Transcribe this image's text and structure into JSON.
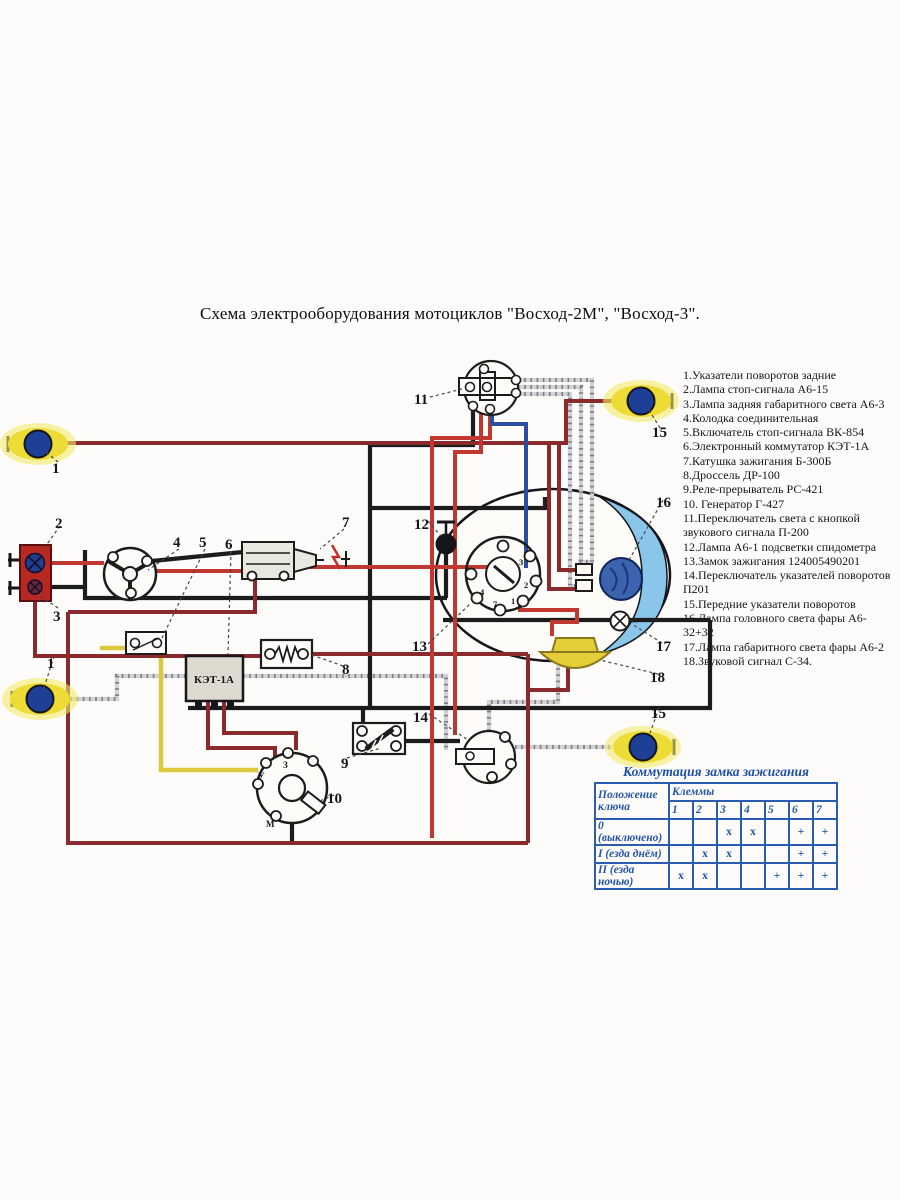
{
  "title": "Схема электрооборудования мотоциклов \"Восход-2М\", \"Восход-3\".",
  "legend": {
    "items": [
      "1.Указатели поворотов задние",
      "2.Лампа стоп-сигнала А6-15",
      "3.Лампа задняя габаритного света А6-3",
      "4.Колодка соединительная",
      "5.Включатель стоп-сигнала ВК-854",
      "6.Электронный коммутатор КЭТ-1А",
      "7.Катушка зажигания Б-300Б",
      "8.Дроссель ДР-100",
      "9.Реле-прерыватель РС-421",
      "10. Генератор Г-427",
      "11.Переключатель света с кнопкой звукового сигнала П-200",
      "12.Лампа А6-1 подсветки спидометра",
      "13.Замок зажигания 124005490201",
      "14.Переключатель указателей поворотов П201",
      "15.Передние указатели поворотов",
      "16.Лампа головного света фары А6-32+32",
      "17.Лампа габаритного света фары А6-2",
      "18.Звуковой сигнал С-34."
    ]
  },
  "table": {
    "title": "Коммутация замка зажигания",
    "key_position_header": "Положение ключа",
    "terminals_header": "Клеммы",
    "terminals": [
      "1",
      "2",
      "3",
      "4",
      "5",
      "6",
      "7"
    ],
    "rows": [
      {
        "label": "0 (выключено)",
        "cells": [
          "",
          "",
          "x",
          "x",
          "",
          "+",
          "+"
        ]
      },
      {
        "label": "I (езда днём)",
        "cells": [
          "",
          "x",
          "x",
          "",
          "",
          "+",
          "+"
        ]
      },
      {
        "label": "II (езда ночью)",
        "cells": [
          "x",
          "x",
          "",
          "",
          "+",
          "+",
          "+"
        ]
      }
    ]
  },
  "diagram": {
    "colors": {
      "wire_red": "#c03830",
      "wire_dark_red": "#8a2a2c",
      "wire_black": "#1c1c1e",
      "wire_blue": "#2b4f9e",
      "wire_yellow": "#ddc83b",
      "wire_gray": "#d2d2d6",
      "signal_lens": "#ecdc35",
      "signal_bulb": "#1d3f96",
      "tail_light_body": "#b72822",
      "headlight_lens": "#8ac6ea",
      "headlamp_bulb": "#3b63ae",
      "horn_body": "#e5cd39",
      "table_blue": "#2b5cb0"
    },
    "texts": [
      {
        "t": "1",
        "x": 52,
        "y": 473,
        "s": 15,
        "b": 1
      },
      {
        "t": "1",
        "x": 47,
        "y": 668,
        "s": 15,
        "b": 1
      },
      {
        "t": "2",
        "x": 55,
        "y": 528,
        "s": 15,
        "b": 1
      },
      {
        "t": "3",
        "x": 53,
        "y": 621,
        "s": 15,
        "b": 1
      },
      {
        "t": "4",
        "x": 173,
        "y": 547,
        "s": 15,
        "b": 1
      },
      {
        "t": "5",
        "x": 199,
        "y": 547,
        "s": 15,
        "b": 1
      },
      {
        "t": "6",
        "x": 225,
        "y": 549,
        "s": 15,
        "b": 1
      },
      {
        "t": "7",
        "x": 342,
        "y": 527,
        "s": 15,
        "b": 1
      },
      {
        "t": "8",
        "x": 342,
        "y": 674,
        "s": 15,
        "b": 1
      },
      {
        "t": "9",
        "x": 341,
        "y": 768,
        "s": 15,
        "b": 1
      },
      {
        "t": "10",
        "x": 327,
        "y": 803,
        "s": 15,
        "b": 1
      },
      {
        "t": "11",
        "x": 414,
        "y": 404,
        "s": 15,
        "b": 1
      },
      {
        "t": "12",
        "x": 414,
        "y": 529,
        "s": 15,
        "b": 1
      },
      {
        "t": "13",
        "x": 412,
        "y": 651,
        "s": 15,
        "b": 1
      },
      {
        "t": "14",
        "x": 413,
        "y": 722,
        "s": 15,
        "b": 1
      },
      {
        "t": "15",
        "x": 652,
        "y": 437,
        "s": 15,
        "b": 1
      },
      {
        "t": "15",
        "x": 651,
        "y": 718,
        "s": 15,
        "b": 1
      },
      {
        "t": "16",
        "x": 656,
        "y": 507,
        "s": 15,
        "b": 1
      },
      {
        "t": "17",
        "x": 656,
        "y": 651,
        "s": 15,
        "b": 1
      },
      {
        "t": "18",
        "x": 650,
        "y": 682,
        "s": 15,
        "b": 1
      },
      {
        "t": "КЭТ-1А",
        "x": 214,
        "y": 683,
        "s": 11,
        "b": 1,
        "a": "middle"
      },
      {
        "t": "У",
        "x": 258,
        "y": 779,
        "s": 9,
        "b": 1
      },
      {
        "t": "З",
        "x": 283,
        "y": 768,
        "s": 9,
        "b": 1
      },
      {
        "t": "М",
        "x": 266,
        "y": 827,
        "s": 9,
        "b": 1
      },
      {
        "t": "3",
        "x": 519,
        "y": 565,
        "s": 8.5,
        "b": 1
      },
      {
        "t": "2",
        "x": 524,
        "y": 588,
        "s": 8.5,
        "b": 1
      },
      {
        "t": "1",
        "x": 511,
        "y": 604,
        "s": 8.5,
        "b": 1
      },
      {
        "t": "7",
        "x": 493,
        "y": 607,
        "s": 8.5,
        "b": 1
      },
      {
        "t": "4",
        "x": 480,
        "y": 595,
        "s": 8.5,
        "b": 1
      }
    ]
  }
}
